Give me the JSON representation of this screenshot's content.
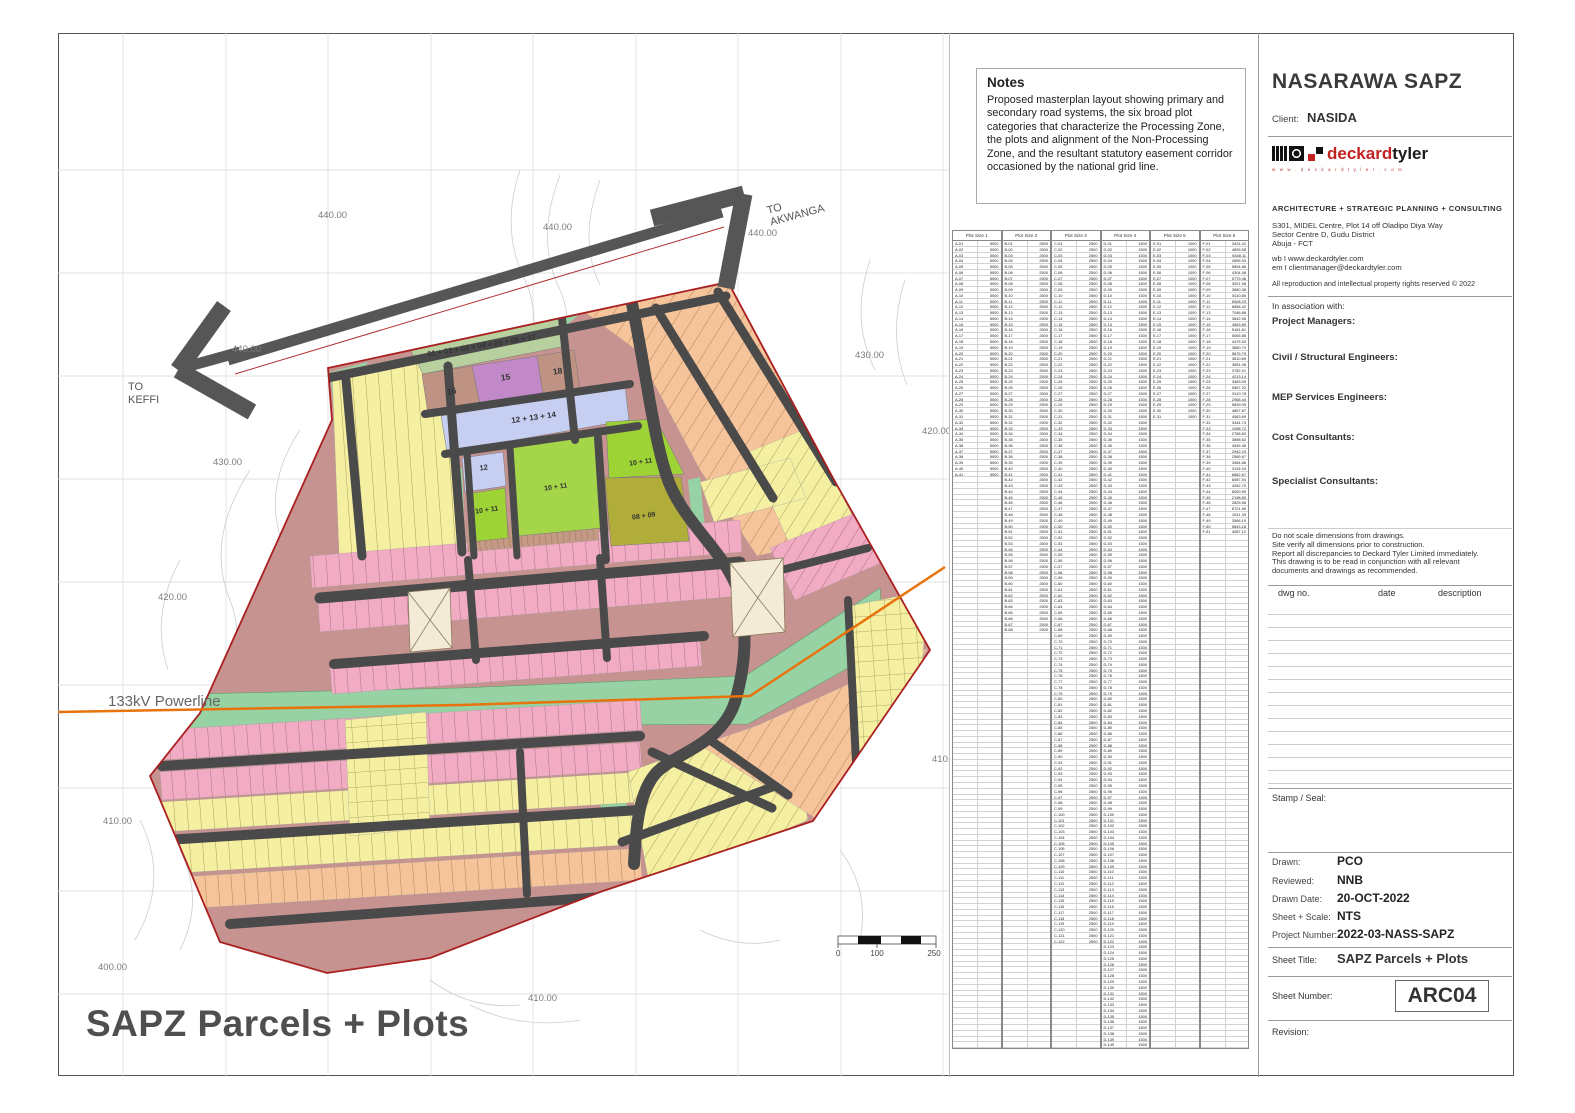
{
  "map": {
    "title": "SAPZ Parcels + Plots",
    "powerline_label": "133kV Powerline",
    "to_keffi_line1": "TO",
    "to_keffi_line2": "KEFFI",
    "to_akwanga_line1": "TO",
    "to_akwanga_line2": "AKWANGA",
    "contour_labels": [
      "440.00",
      "440.00",
      "440.00",
      "440.00",
      "430.00",
      "430.00",
      "420.00",
      "420.00",
      "410.00",
      "410.00",
      "410.00",
      "400.00"
    ],
    "parcel_labels": [
      "01 + 02 + 03 + 04 + 05 + 06 + 07",
      "16",
      "15",
      "18",
      "12 + 13 + 14",
      "12",
      "10 + 11",
      "10 + 11",
      "10 + 11",
      "08 + 09"
    ],
    "scale": {
      "t0": "0",
      "t1": "100",
      "t2": "250"
    }
  },
  "notes": {
    "title": "Notes",
    "body": "Proposed masterplan layout showing primary and secondary road systems, the six broad plot categories that characterize the Processing Zone, the plots and alignment of the Non-Processing Zone, and the resultant statutory easement corridor occasioned by the national grid line."
  },
  "plot_table": {
    "row_count": 140,
    "groups": [
      {
        "header": "Plot Size 1",
        "prefix": "A",
        "count": 41,
        "size": "5000"
      },
      {
        "header": "Plot Size 2",
        "prefix": "B",
        "count": 68,
        "size": "2500"
      },
      {
        "header": "Plot Size 3",
        "prefix": "C",
        "count": 122,
        "size": "2500"
      },
      {
        "header": "Plot Size 4",
        "prefix": "D",
        "count": 140,
        "size": "1500"
      },
      {
        "header": "Plot Size 5",
        "prefix": "E",
        "count": 31,
        "size": "1000"
      },
      {
        "header": "Plot Size 6",
        "prefix": "F",
        "count": 51,
        "sizes": [
          "3424.42",
          "4805.58",
          "6348.11",
          "2855.33",
          "5894.86",
          "4304.48",
          "5779.46",
          "3921.58",
          "3880.36",
          "8110.85",
          "6508.23",
          "6858.42",
          "7048.88",
          "3842.55",
          "4563.89",
          "5181.61",
          "5065.88",
          "4475.53",
          "3860.70",
          "5875.79",
          "3610.69",
          "3651.08",
          "3782.01",
          "4213.14",
          "3483.09",
          "5567.22",
          "5110.78",
          "2968.44",
          "5839.05",
          "4857.87",
          "4563.69",
          "3344.73",
          "1998.72",
          "2788.83",
          "3898.62",
          "4545.46",
          "2942.23",
          "2565.67",
          "3464.86",
          "3124.03",
          "6862.67",
          "8087.54",
          "4262.70",
          "8000.55",
          "2198.80",
          "2825.58",
          "6721.56",
          "2511.39",
          "3568.19",
          "5843.18",
          "4087.12"
        ]
      }
    ]
  },
  "title_block": {
    "project": "NASARAWA SAPZ",
    "client_label": "Client:",
    "client": "NASIDA",
    "logo_brand_red": "deckard",
    "logo_brand_black": "tyler",
    "logo_tagline": "w w w . d e c k a r d t y l e r . c o m",
    "services": "ARCHITECTURE  +  STRATEGIC PLANNING  +  CONSULTING",
    "address_lines": [
      "S301, MIDEL Centre, Plot 14 off Oladipo Diya Way",
      "Sector Centre D, Gudu District",
      "Abuja - FCT"
    ],
    "web": "wb I www.deckardtyler.com",
    "email": "em I clientmanager@deckardtyler.com",
    "rights": "All reproduction and intellectual property rights reserved © 2022",
    "association": "In association with:",
    "roles": [
      "Project Managers:",
      "Civil / Structural Engineers:",
      "MEP Services Engineers:",
      "Cost Consultants:",
      "Specialist Consultants:"
    ],
    "disclaimer_lines": [
      "Do not scale dimensions from drawings.",
      "Site verify all dimensions prior to construction.",
      "Report all discrepancies to Deckard Tyler Limited immediately.",
      "This drawing is to be read in conjunction with all relevant",
      "documents and drawings as recommended."
    ],
    "revision_headers": [
      "dwg no.",
      "date",
      "description"
    ],
    "stamp_label": "Stamp / Seal:",
    "meta": [
      {
        "label": "Drawn:",
        "value": "PCO"
      },
      {
        "label": "Reviewed:",
        "value": "NNB"
      },
      {
        "label": "Drawn Date:",
        "value": "20-OCT-2022"
      },
      {
        "label": "Sheet + Scale:",
        "value": "NTS"
      },
      {
        "label": "Project Number:",
        "value": "2022-03-NASS-SAPZ"
      }
    ],
    "sheet_title_label": "Sheet Title:",
    "sheet_title": "SAPZ Parcels + Plots",
    "sheet_number_label": "Sheet Number:",
    "sheet_number": "ARC04",
    "revision_label": "Revision:"
  },
  "colors": {
    "road": "#4a4a4a",
    "boundary_red": "#aa1f1f",
    "powerline_orange": "#e8720c",
    "easement_green": "#97d2a4",
    "pink": "#f1abc3",
    "yellow": "#f5efa2",
    "peach": "#f5c49a",
    "mauve": "#c69391",
    "lime": "#9ed336",
    "olive": "#b0ad3a",
    "lavender": "#c6cff2",
    "purple": "#c289c9",
    "green_parcel": "#b8cf9e",
    "brand_red": "#c32222"
  }
}
